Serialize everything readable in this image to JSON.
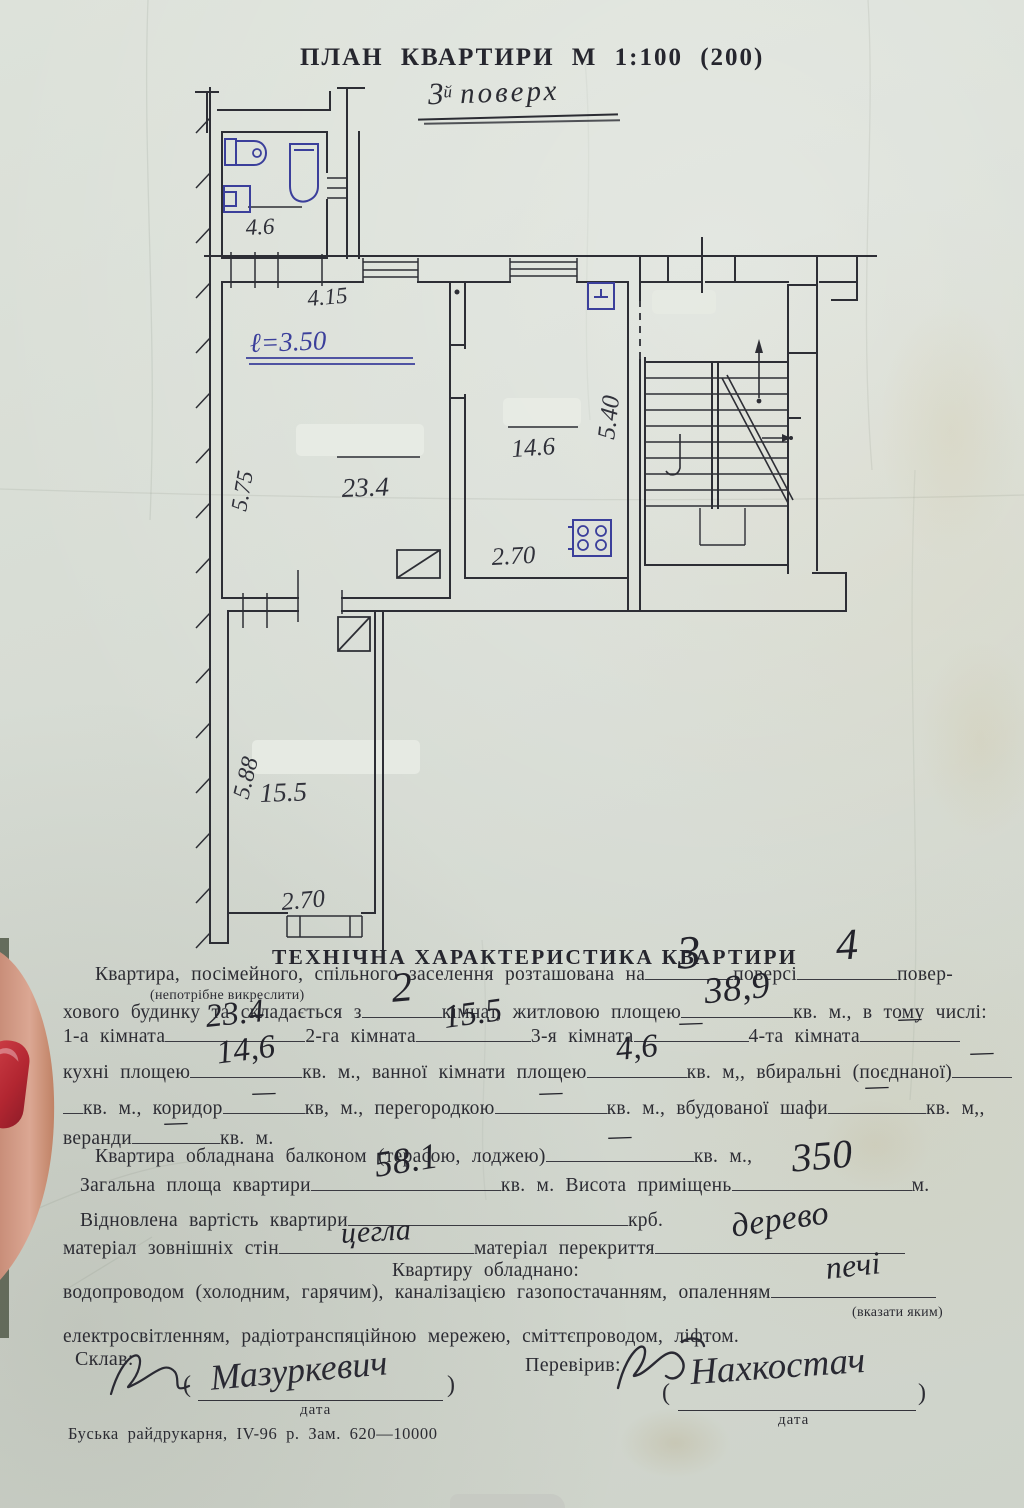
{
  "colors": {
    "ink": "#2d2e35",
    "blue_ink": "#3b3f9b",
    "nail_red": "#b72f38",
    "paper": "#d6dbd3"
  },
  "plan": {
    "title": "ПЛАН КВАРТИРИ М  1:100 (200)",
    "floor_note_num": "3",
    "floor_note_sup": "й",
    "floor_note_word": "поверх",
    "labels": {
      "bath_area": "4.6",
      "room1_top_dim": "4.15",
      "room1_left_dim": "5.75",
      "height_note": "ℓ=3.50",
      "room1_area": "23.4",
      "kitchen_area": "14.6",
      "kitchen_right_dim": "5.40",
      "kitchen_bottom_dim": "2.70",
      "room2_area": "15.5",
      "room2_left_dim": "5.88",
      "room2_bottom_dim": "2.70"
    }
  },
  "tech": {
    "heading": "ТЕХНІЧНА ХАРАКТЕРИСТИКА КВАРТИРИ",
    "dash": "—",
    "l1a": "Квартира, посімейного, спільного заселення розташована на",
    "l1v1": "3",
    "l1b": "поверсі",
    "l1v2": "4",
    "l1c": "повер-",
    "note": "(непотрібне викреслити)",
    "l2a": "хового будинку та складається з",
    "l2v1": "2",
    "l2b": "кімнат, житловою площею",
    "l2v2": "38,9",
    "l2c": "кв. м., в тому числі:",
    "l3a": "1-а кімната",
    "l3v1": "23.4",
    "l3b": "2-га кімната",
    "l3v2": "15.5",
    "l3c": "3-я кімната",
    "l3d": "4-та кімната",
    "l4a": "кухні площею",
    "l4v1": "14,6",
    "l4b": "кв. м., ванної кімнати площею",
    "l4v2": "4,6",
    "l4c": "кв. м,, вбиральні (поєднаної)",
    "l5a": "кв. м., коридор",
    "l5b": "кв, м., перегородкою",
    "l5c": "кв. м., вбудованої шафи",
    "l5d": "кв. м,,",
    "l6a": "веранди",
    "l6b": "кв. м.",
    "l7a": "Квартира обладнана балконом (терасою, лоджею)",
    "l7b": "кв. м.,",
    "l8a": "Загальна площа квартири",
    "l8v1": "58.1",
    "l8b": "кв. м. Висота приміщень",
    "l8v2": "350",
    "l8c": "м.",
    "l9a": "Відновлена вартість квартири",
    "l9b": "крб.",
    "l10a": "матеріал зовнішніх стін",
    "l10v1": "цегла",
    "l10b": "матеріал перекриття",
    "l10v2": "дерево",
    "l11": "Квартиру обладнано:",
    "l12a": "водопроводом (холодним, гарячим), каналізацією газопостачанням, опаленням",
    "l12v1": "печі",
    "l12note": "(вказати яким)",
    "l13": "електросвітленням, радіотранспяційною мережею, сміттєпроводом, ліфтом.",
    "made_label": "Склав:",
    "made_sig": "Мазуркевич",
    "checked_label": "Перевірив:",
    "checked_sig": "Нахкостач",
    "bracket_open": "(",
    "bracket_close": ")",
    "date_label": "дата",
    "print_line": "Буська райдрукарня, ІV-96 р. Зам. 620—10000"
  }
}
